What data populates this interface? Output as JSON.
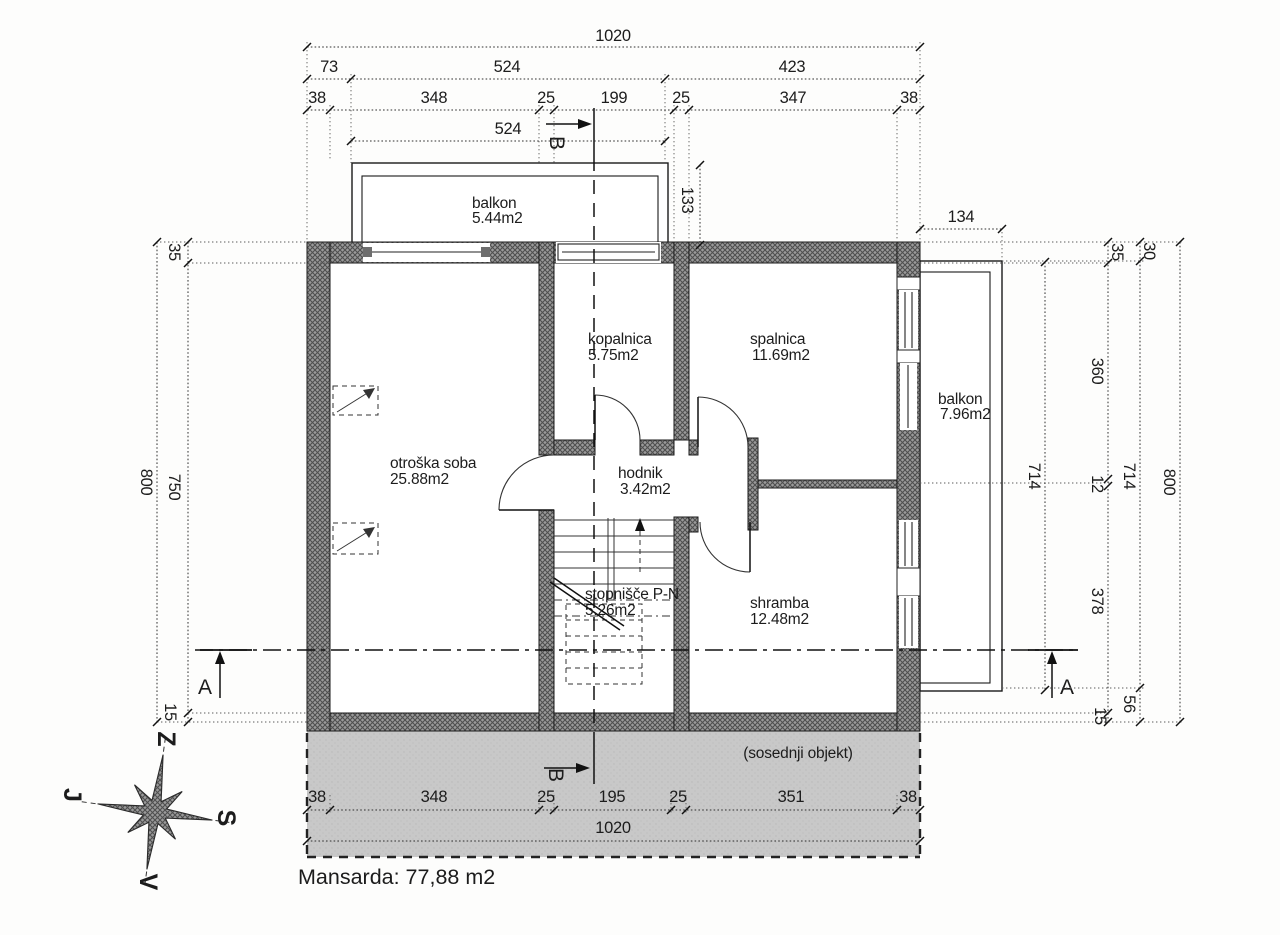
{
  "drawing": {
    "title": "Mansarda: 77,88 m2",
    "neighbor_label": "(sosednji objekt)"
  },
  "rooms": {
    "otroska": {
      "name": "otroška soba",
      "area": "25.88m2"
    },
    "kopalnica": {
      "name": "kopalnica",
      "area": "5.75m2"
    },
    "spalnica": {
      "name": "spalnica",
      "area": "11.69m2"
    },
    "hodnik": {
      "name": "hodnik",
      "area": "3.42m2"
    },
    "stopnisce": {
      "name": "stopnišče P-N",
      "area": "5.26m2"
    },
    "shramba": {
      "name": "shramba",
      "area": "12.48m2"
    },
    "balkon_top": {
      "name": "balkon",
      "area": "5.44m2"
    },
    "balkon_right": {
      "name": "balkon",
      "area": "7.96m2"
    }
  },
  "sections": {
    "a": "A",
    "b": "B"
  },
  "compass": {
    "top": "Z",
    "left": "J",
    "right": "S",
    "bottom": "V"
  },
  "colors": {
    "wall": "#7a7a7a",
    "neighbor": "#c7c7c7",
    "ink": "#1c1c1c"
  },
  "dims": {
    "t_1020": "1020",
    "t_73": "73",
    "t_524a": "524",
    "t_423": "423",
    "t_38a": "38",
    "t_348": "348",
    "t_25a": "25",
    "t_199": "199",
    "t_25b": "25",
    "t_347": "347",
    "t_38b": "38",
    "t_524b": "524",
    "balk_depth": "133",
    "balk_width": "134",
    "l_800": "800",
    "l_35": "35",
    "l_750": "750",
    "l_15": "15",
    "r_714a": "714",
    "r_35": "35",
    "r_360": "360",
    "r_12": "12",
    "r_378": "378",
    "r_15": "15",
    "r_30": "30",
    "r_714b": "714",
    "r_56": "56",
    "r_800": "800",
    "b_38a": "38",
    "b_348": "348",
    "b_25a": "25",
    "b_195": "195",
    "b_25b": "25",
    "b_351": "351",
    "b_38b": "38",
    "b_1020": "1020"
  }
}
